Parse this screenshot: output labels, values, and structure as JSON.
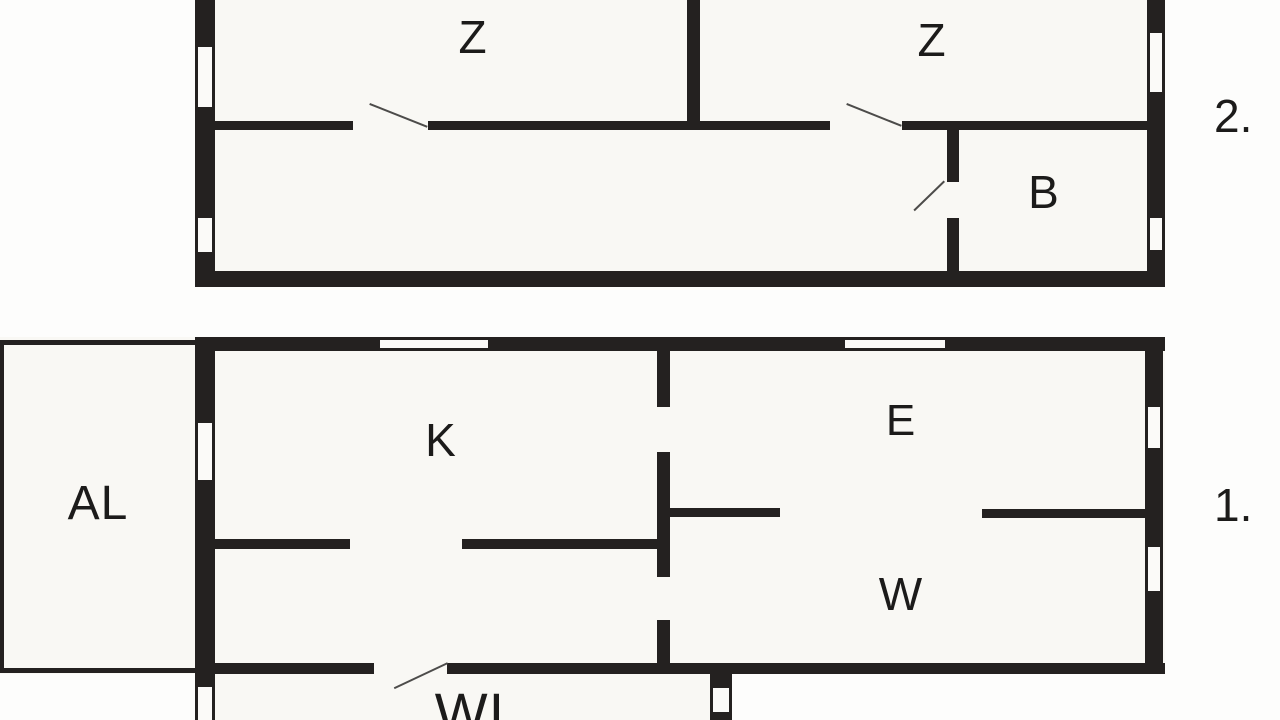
{
  "title": "Two-storey apartment floor plan",
  "colors": {
    "background": "#fdfdfc",
    "floor_fill": "#f9f8f4",
    "wall": "#242120",
    "door_swing": "#4d4c4a",
    "label": "#1c1b1a"
  },
  "floor_labels": [
    {
      "text": "2.",
      "floor": "second"
    },
    {
      "text": "1.",
      "floor": "first"
    }
  ],
  "plan": {
    "areas": [
      {
        "x": 195,
        "y": 0,
        "w": 970,
        "h": 287
      },
      {
        "x": 0,
        "y": 337,
        "w": 1165,
        "h": 337
      },
      {
        "x": 195,
        "y": 663,
        "w": 537,
        "h": 57
      }
    ],
    "walls": [
      [
        195,
        0,
        20,
        287
      ],
      [
        1147,
        0,
        18,
        287
      ],
      [
        195,
        271,
        970,
        16
      ],
      [
        687,
        0,
        13,
        127
      ],
      [
        215,
        121,
        138,
        9
      ],
      [
        428,
        121,
        402,
        9
      ],
      [
        902,
        121,
        245,
        9
      ],
      [
        947,
        121,
        12,
        61
      ],
      [
        947,
        218,
        12,
        55
      ],
      [
        195,
        337,
        970,
        14
      ],
      [
        195,
        337,
        20,
        350
      ],
      [
        1145,
        337,
        18,
        337
      ],
      [
        195,
        663,
        179,
        11
      ],
      [
        447,
        663,
        263,
        11
      ],
      [
        732,
        663,
        433,
        11
      ],
      [
        710,
        663,
        22,
        57
      ],
      [
        657,
        337,
        13,
        70
      ],
      [
        657,
        452,
        13,
        125
      ],
      [
        657,
        620,
        13,
        45
      ],
      [
        215,
        539,
        135,
        10
      ],
      [
        462,
        539,
        208,
        10
      ],
      [
        670,
        508,
        110,
        9
      ],
      [
        982,
        509,
        165,
        9
      ],
      [
        0,
        340,
        195,
        5
      ],
      [
        0,
        340,
        4,
        333
      ],
      [
        0,
        668,
        195,
        5
      ]
    ],
    "windows": [
      {
        "x": 195,
        "y": 47,
        "w": 20,
        "h": 60,
        "o": "v"
      },
      {
        "x": 195,
        "y": 218,
        "w": 20,
        "h": 34,
        "o": "v"
      },
      {
        "x": 1147,
        "y": 33,
        "w": 18,
        "h": 59,
        "o": "v"
      },
      {
        "x": 1147,
        "y": 218,
        "w": 18,
        "h": 32,
        "o": "v"
      },
      {
        "x": 380,
        "y": 337,
        "w": 108,
        "h": 14,
        "o": "h"
      },
      {
        "x": 845,
        "y": 337,
        "w": 100,
        "h": 14,
        "o": "h"
      },
      {
        "x": 195,
        "y": 423,
        "w": 20,
        "h": 57,
        "o": "v"
      },
      {
        "x": 1145,
        "y": 407,
        "w": 18,
        "h": 41,
        "o": "v"
      },
      {
        "x": 1145,
        "y": 547,
        "w": 18,
        "h": 44,
        "o": "v"
      },
      {
        "x": 195,
        "y": 687,
        "w": 20,
        "h": 33,
        "o": "v"
      },
      {
        "x": 710,
        "y": 688,
        "w": 22,
        "h": 24,
        "o": "v"
      }
    ],
    "doors": [
      {
        "x1": 370,
        "y1": 103,
        "x2": 428,
        "y2": 126
      },
      {
        "x1": 847,
        "y1": 103,
        "x2": 902,
        "y2": 125
      },
      {
        "x1": 945,
        "y1": 182,
        "x2": 915,
        "y2": 211
      },
      {
        "x1": 448,
        "y1": 664,
        "x2": 395,
        "y2": 689
      }
    ],
    "rooms": [
      {
        "label": "Z",
        "x": 473,
        "y": 37,
        "size": 46
      },
      {
        "label": "Z",
        "x": 932,
        "y": 40,
        "size": 46
      },
      {
        "label": "B",
        "x": 1044,
        "y": 192,
        "size": 46
      },
      {
        "label": "AL",
        "x": 98,
        "y": 504,
        "size": 48
      },
      {
        "label": "K",
        "x": 441,
        "y": 440,
        "size": 46
      },
      {
        "label": "E",
        "x": 901,
        "y": 421,
        "size": 44
      },
      {
        "label": "W",
        "x": 901,
        "y": 594,
        "size": 46
      },
      {
        "label": "WI",
        "x": 470,
        "y": 713,
        "size": 56
      }
    ]
  }
}
